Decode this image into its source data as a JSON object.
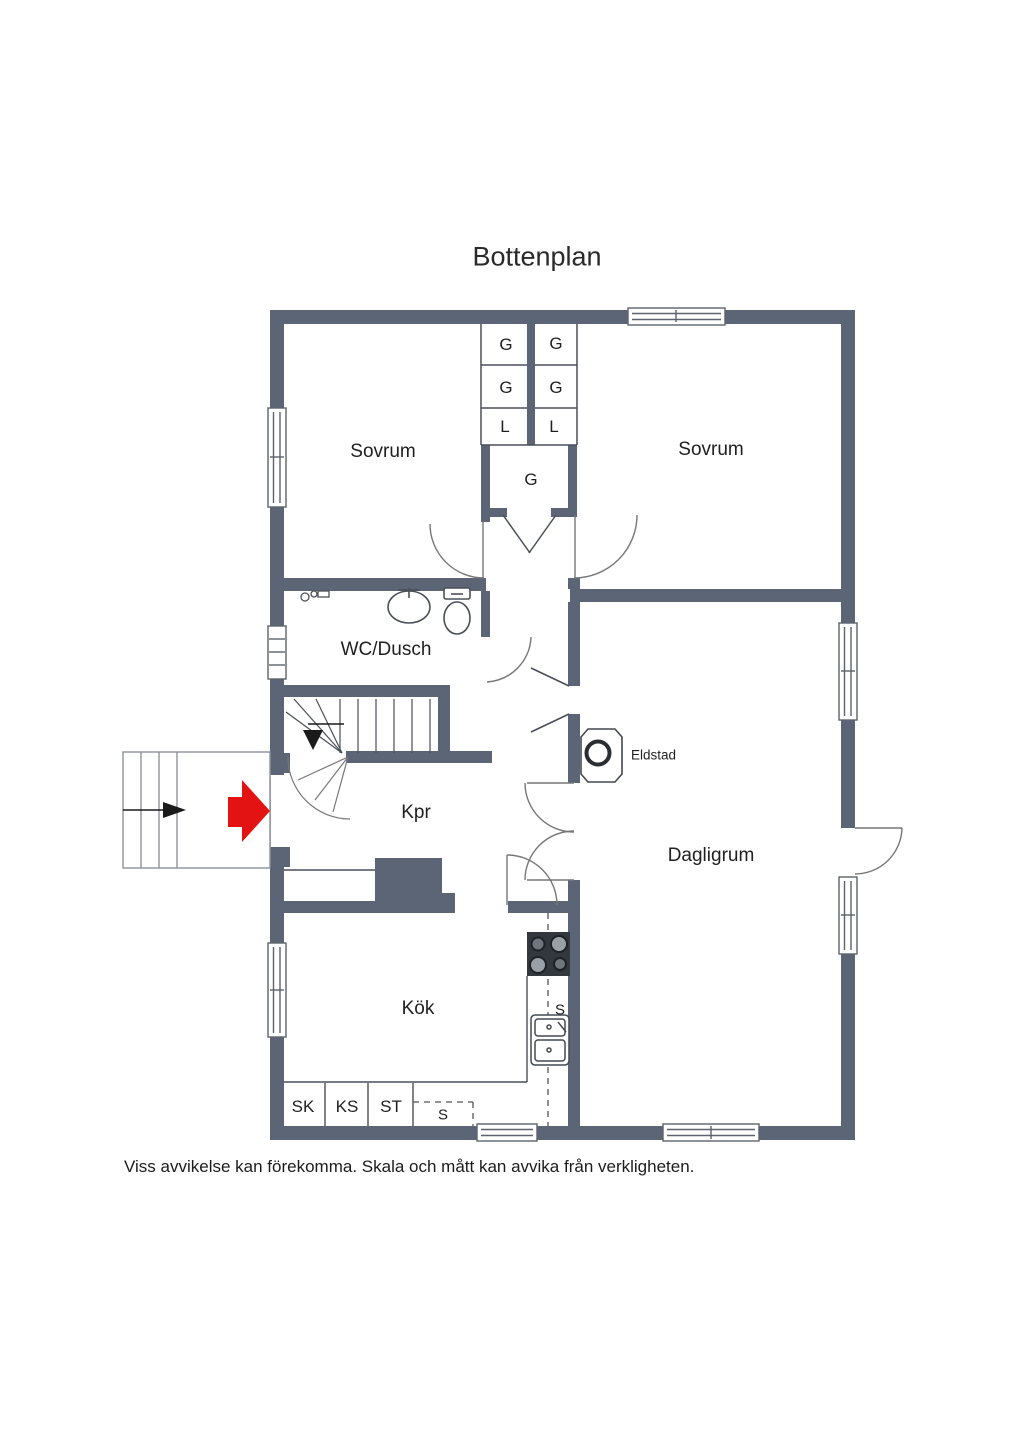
{
  "title": "Bottenplan",
  "disclaimer": "Viss avvikelse kan förekomma. Skala och mått kan avvika från verkligheten.",
  "rooms": {
    "sovrum_left": "Sovrum",
    "sovrum_right": "Sovrum",
    "wc": "WC/Dusch",
    "kpr": "Kpr",
    "dagligrum": "Dagligrum",
    "kok": "Kök"
  },
  "fixtures": {
    "eldstad_label": "Eldstad"
  },
  "closets": {
    "col1": [
      "G",
      "G",
      "L"
    ],
    "col2": [
      "G",
      "G",
      "L"
    ],
    "hall_closet": "G"
  },
  "kitchen_units": [
    "SK",
    "KS",
    "ST"
  ],
  "kitchen_dashed_unit": "S",
  "sink_label": "S",
  "colors": {
    "wall": "#5b6575",
    "thin_line": "#4a4f58",
    "door_arc": "#777777",
    "entry_arrow": "#e41313",
    "stove_body": "#33383f",
    "text": "#1f1f1f",
    "background": "#ffffff"
  }
}
